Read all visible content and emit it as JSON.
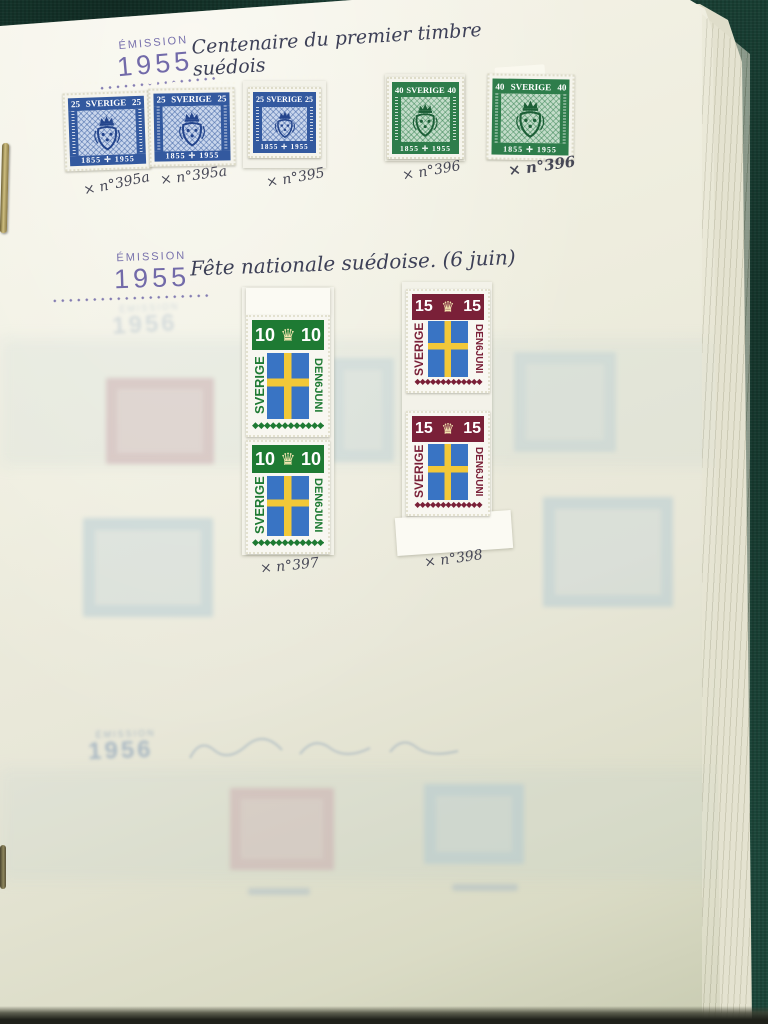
{
  "photo": {
    "subject": "Stamp album page with Swedish 1955 stamps",
    "colors": {
      "album_cover_green": "#1c473a",
      "page_cream": "#ecebdf",
      "emission_ink_purple": "#6b63a6",
      "handwriting_ink": "#3d4057",
      "classic_stamp_blue": "#33599f",
      "classic_stamp_green": "#2e7d4b",
      "flag_stamp_green": "#1e7a33",
      "flag_stamp_maroon": "#7a2038",
      "flag_blue": "#3974c4",
      "flag_yellow": "#f2c838"
    }
  },
  "album": {
    "emission": {
      "label": "ÉMISSION",
      "year": "1955"
    },
    "section1": {
      "title": "Centenaire du premier timbre suédois"
    },
    "section2": {
      "title": "Fête nationale suédoise. (6 juin)"
    },
    "classic": {
      "country": "SVERIGE",
      "years": "1855 ✛ 1955",
      "blue_value": "25",
      "green_value": "40"
    },
    "flag": {
      "country": "SVERIGE",
      "date": "DEN6JUNI",
      "green_value": "10",
      "red_value": "15",
      "crown": "♛",
      "diamond_row": "◆◆◆◆◆◆◆◆◆◆◆◆◆"
    },
    "labels": {
      "l1": "× n°395a",
      "l2": "× n°395a",
      "l3": "× n°395",
      "l4": "× n°396",
      "l5": "× n°396",
      "l6": "× n°397",
      "l7": "× n°398"
    },
    "ghost": {
      "year": "1956",
      "emission_label": "ÉMISSION"
    }
  }
}
